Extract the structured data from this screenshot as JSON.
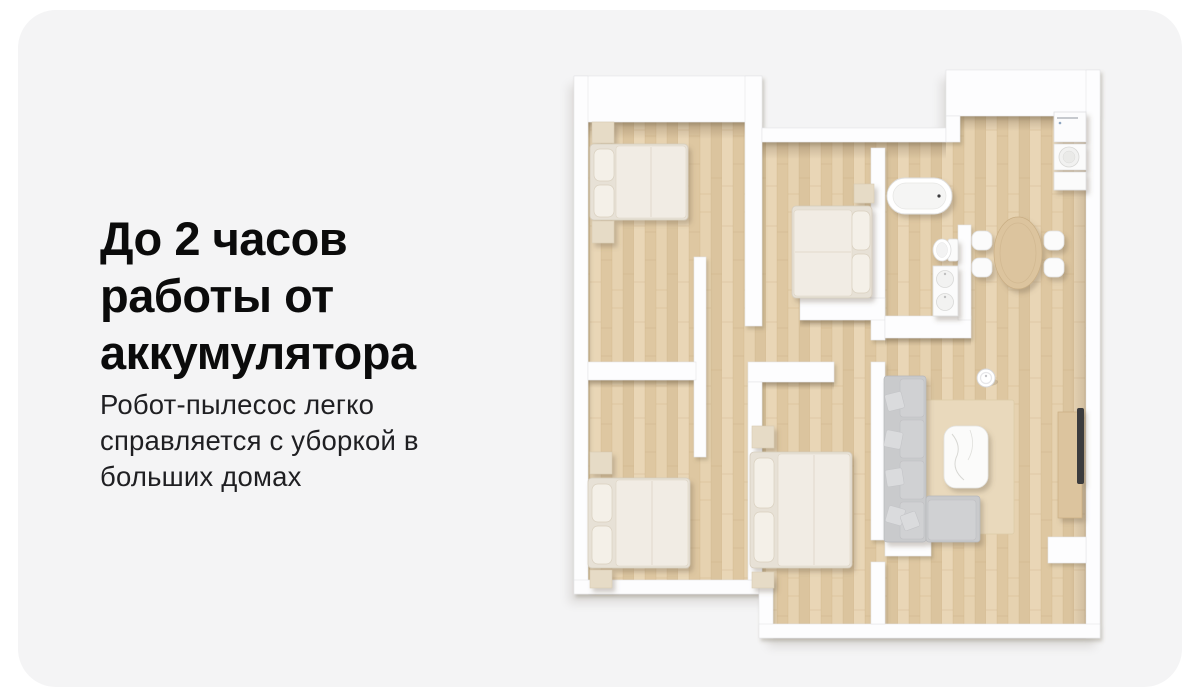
{
  "card": {
    "title_lines": [
      "До 2 часов",
      "работы от",
      "аккумулятора"
    ],
    "subtitle_lines": [
      "Робот-пылесос легко",
      "справляется с уборкой в",
      "больших домах"
    ]
  },
  "floorplan": {
    "type": "apartment-top-view-3d-render",
    "rooms": [
      "bedroom-top-left",
      "bedroom-middle",
      "bedroom-bottom-left",
      "bedroom-bottom-middle",
      "bathroom",
      "kitchen-laundry-nook",
      "dining-area",
      "living-room",
      "hallway"
    ],
    "furniture": [
      "double-bed-top-left",
      "double-bed-middle",
      "double-bed-bottom-left",
      "double-bed-bottom-middle",
      "bathtub",
      "toilet",
      "double-sink-vanity",
      "washing-machine",
      "laundry-basin",
      "oval-dining-table",
      "dining-chairs-4",
      "sectional-sofa",
      "marble-coffee-table",
      "area-rug",
      "tv-console",
      "tv",
      "robot-vacuum"
    ]
  },
  "palette": {
    "page_background": "#ffffff",
    "card_background": "#f4f4f5",
    "headline_text": "#0b0b0b",
    "body_text": "#1f1f22",
    "floor_wood": "#e4cfae",
    "wall_white": "#fdfdfe",
    "sofa_gray": "#c9cacc",
    "rug_beige": "#e9d9bc",
    "wood_furniture": "#dcc49e",
    "tv_black": "#3a3a3c"
  }
}
